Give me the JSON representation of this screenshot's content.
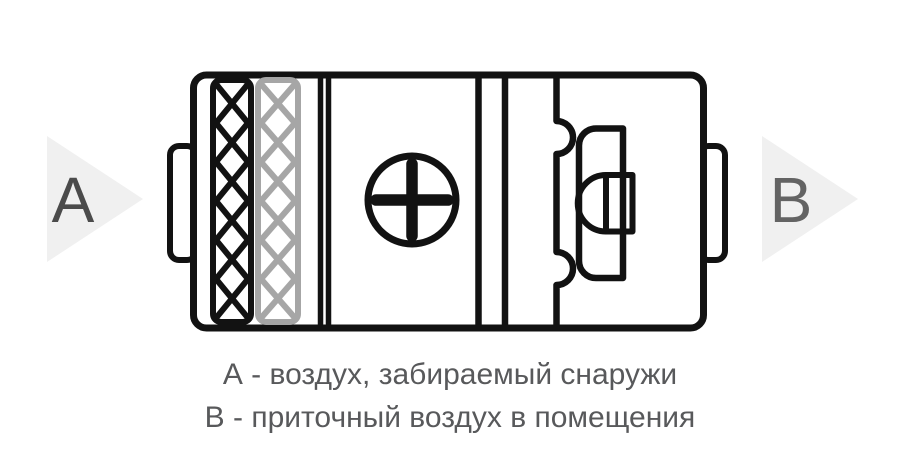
{
  "legend": {
    "label_a": "А",
    "label_b": "В",
    "caption_line1": "А - воздух, забираемый снаружи",
    "caption_line2": "В - приточный воздух в помещения"
  },
  "icons": {
    "heater": "plus-in-circle",
    "filter_primary": "black-zigzag-lattice-strip",
    "filter_secondary": "gray-zigzag-lattice-strip",
    "fan": "impeller-spool-with-motor",
    "airflow": "right-pointing-triangle-arrow"
  },
  "colors": {
    "background": "#ffffff",
    "outline": "#121212",
    "filter_gray": "#a6a6a6",
    "arrow_fill": "#f0f0f0",
    "label_a_color": "#4b4b4b",
    "label_b_color": "#636363",
    "caption_color": "#58595b"
  }
}
